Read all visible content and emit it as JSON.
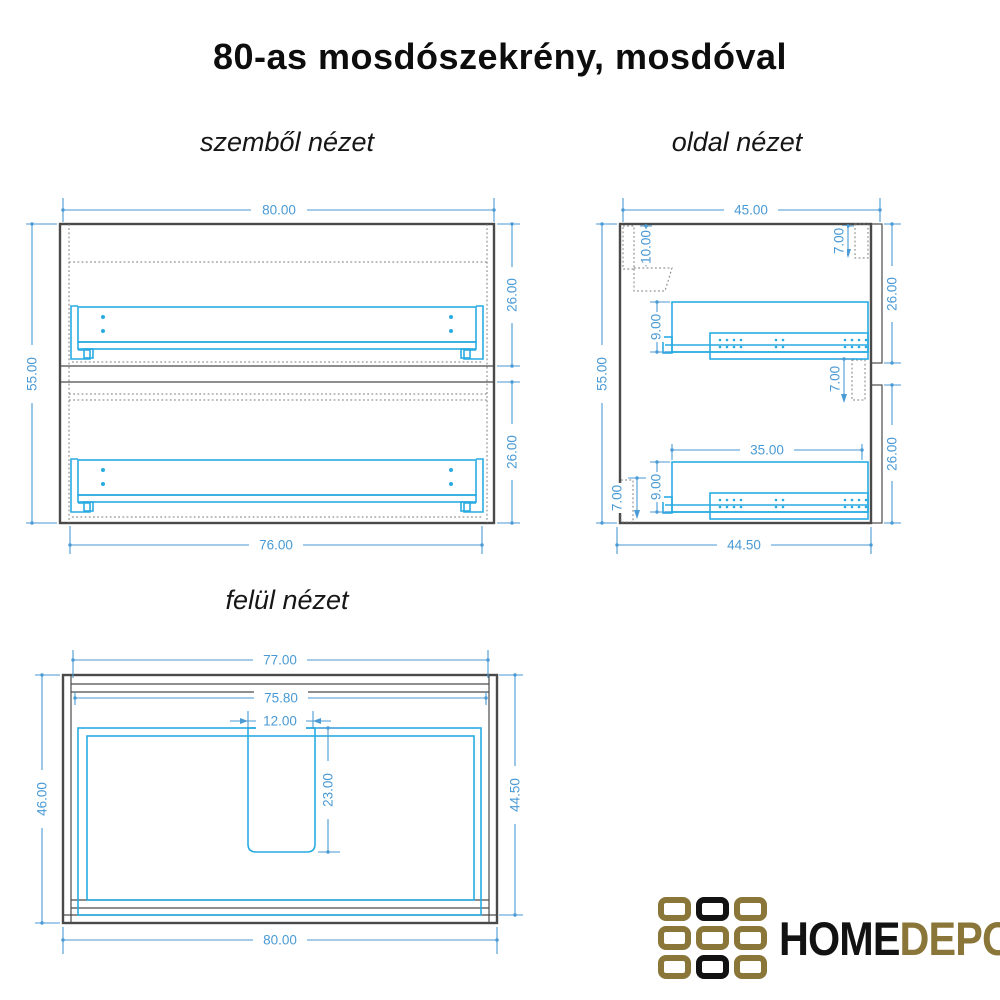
{
  "title": "80-as mosdószekrény, mosdóval",
  "front_view": {
    "label": "szemből nézet",
    "dim_width_top": "80.00",
    "dim_height_left": "55.00",
    "dim_drawer_upper": "26.00",
    "dim_drawer_lower": "26.00",
    "dim_width_bottom": "76.00"
  },
  "side_view": {
    "label": "oldal nézet",
    "dim_depth_top": "45.00",
    "dim_height_left": "55.00",
    "dim_back_rail": "10.00",
    "dim_bracket_top": "7.00",
    "dim_front_upper": "26.00",
    "dim_rail_upper": "9.00",
    "dim_bracket_mid": "7.00",
    "dim_drawer_depth": "35.00",
    "dim_rail_lower": "9.00",
    "dim_bracket_bottom": "7.00",
    "dim_front_lower": "26.00",
    "dim_depth_bottom": "44.50"
  },
  "top_view": {
    "label": "felül nézet",
    "dim_width_outer_top": "77.00",
    "dim_width_inner": "75.80",
    "dim_cutout_width": "12.00",
    "dim_cutout_depth": "23.00",
    "dim_depth_left": "46.00",
    "dim_depth_right": "44.50",
    "dim_width_bottom": "80.00"
  },
  "logo": {
    "home": "HOME",
    "depo": "DEPO"
  },
  "colors": {
    "dimension_blue": "#4a9ad5",
    "hardware_cyan": "#29abe2",
    "outline_dark": "#4a4a4a",
    "logo_gold": "#8a7639",
    "logo_black": "#121212"
  }
}
